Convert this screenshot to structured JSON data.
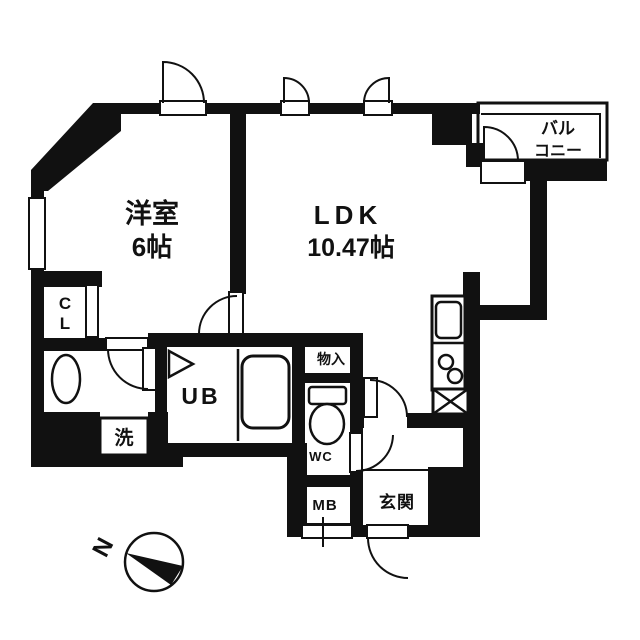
{
  "rooms": {
    "bedroom": {
      "name": "洋室",
      "size": "6帖"
    },
    "ldk": {
      "name": "LDK",
      "size": "10.47帖"
    },
    "balcony": {
      "name_line1": "バル",
      "name_line2": "コニー"
    },
    "closet": {
      "letter_top": "C",
      "letter_bottom": "L"
    },
    "washroom": {
      "washer_label": "洗"
    },
    "unit_bath": {
      "label": "UB"
    },
    "storage": {
      "label": "物入"
    },
    "toilet": {
      "label": "WC"
    },
    "meter_box": {
      "label": "MB"
    },
    "entrance": {
      "label": "玄関"
    }
  },
  "compass": {
    "north_label": "N"
  },
  "colors": {
    "ink": "#111111",
    "background": "#ffffff"
  }
}
